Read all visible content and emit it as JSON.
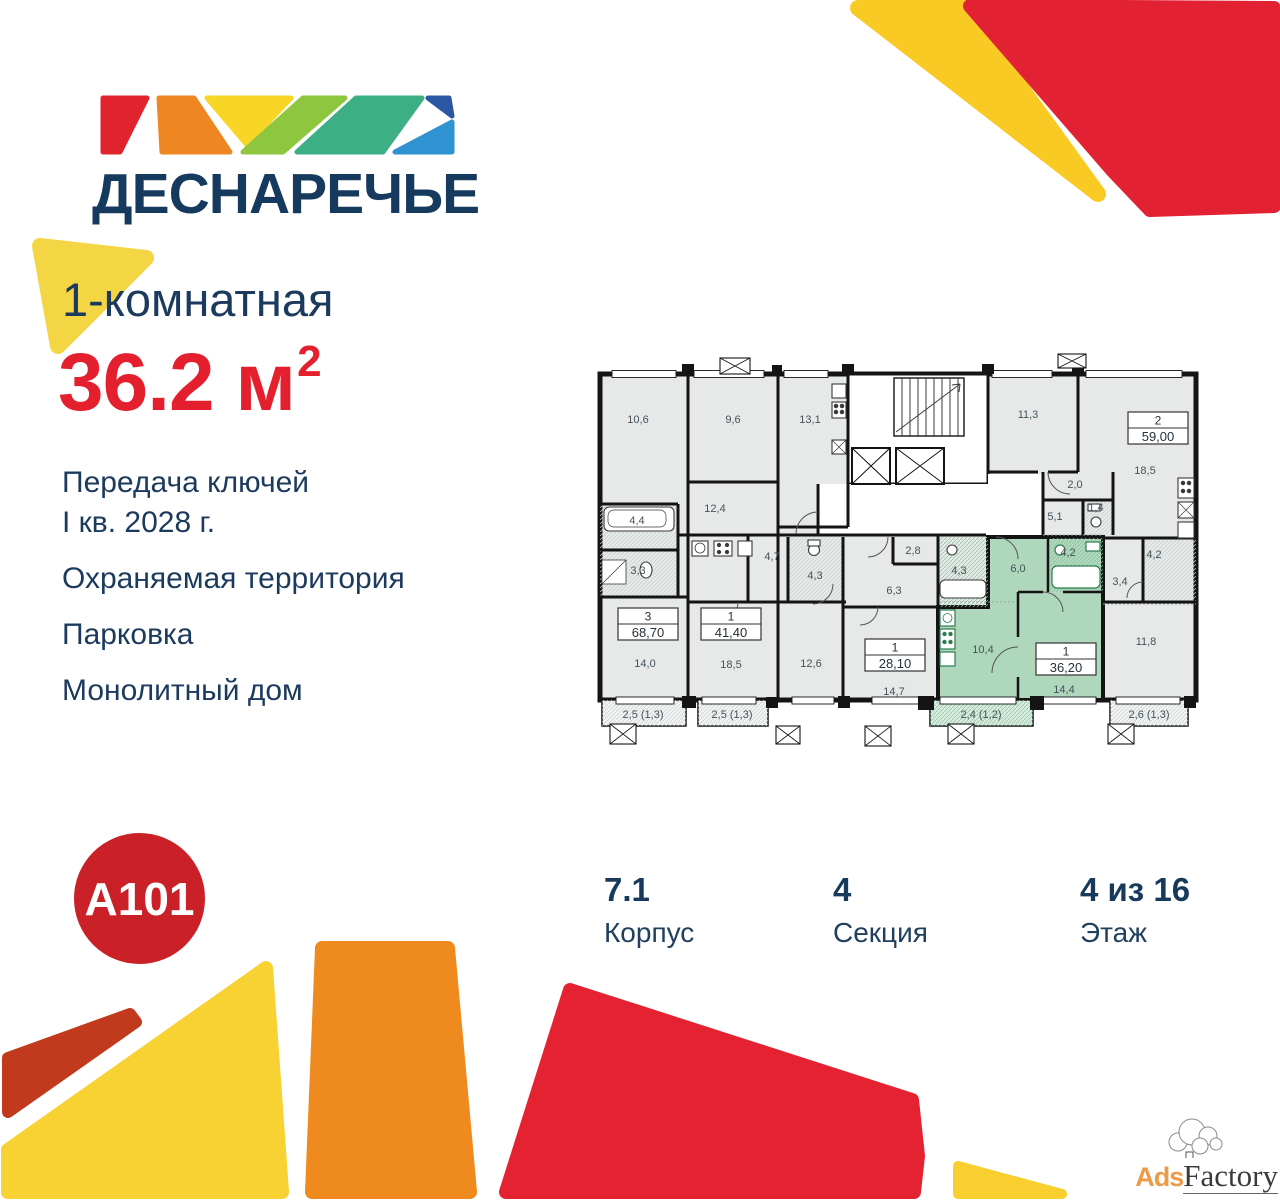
{
  "brand": {
    "name": "ДЕСНАРЕЧЬЕ",
    "developer": "А101"
  },
  "listing": {
    "rooms_label": "1-комнатная",
    "area": "36.2",
    "area_unit": "м",
    "area_sup": "2"
  },
  "features": [
    {
      "lines": [
        "Передача ключей",
        "I кв. 2028 г."
      ]
    },
    {
      "lines": [
        "Охраняемая территория"
      ]
    },
    {
      "lines": [
        "Парковка"
      ]
    },
    {
      "lines": [
        "Монолитный дом"
      ]
    }
  ],
  "stats": [
    {
      "value": "7.1",
      "label": "Корпус"
    },
    {
      "value": "4",
      "label": "Секция"
    },
    {
      "value": "4 из 16",
      "label": "Этаж"
    }
  ],
  "colors": {
    "navy": "#1b3a5d",
    "red": "#e4202e",
    "a101_red": "#c92127",
    "plan_gray": "#e6e9e8",
    "plan_green": "#aed7bb",
    "wall": "#141414",
    "deco_yellow": "#f6d73e",
    "deco_gold": "#f9ca24",
    "deco_orange": "#ee8a1e",
    "deco_red": "#e52231",
    "deco_brick": "#c13a1e"
  },
  "floorplan": {
    "highlighted_apartment": {
      "num": "1",
      "area": "36,20"
    },
    "room_labels": [
      {
        "t": "10,6",
        "x": 50,
        "y": 71
      },
      {
        "t": "9,6",
        "x": 145,
        "y": 71
      },
      {
        "t": "13,1",
        "x": 222,
        "y": 71
      },
      {
        "t": "11,3",
        "x": 440,
        "y": 66
      },
      {
        "t": "12,4",
        "x": 127,
        "y": 160
      },
      {
        "t": "4,4",
        "x": 49,
        "y": 172
      },
      {
        "t": "3,3",
        "x": 50,
        "y": 222
      },
      {
        "t": "4,7",
        "x": 184,
        "y": 208
      },
      {
        "t": "4,3",
        "x": 227,
        "y": 227
      },
      {
        "t": "2,8",
        "x": 325,
        "y": 202
      },
      {
        "t": "4,3",
        "x": 371,
        "y": 222
      },
      {
        "t": "6,3",
        "x": 306,
        "y": 242
      },
      {
        "t": "2,0",
        "x": 487,
        "y": 136
      },
      {
        "t": "5,1",
        "x": 467,
        "y": 168
      },
      {
        "t": "1,4",
        "x": 508,
        "y": 159
      },
      {
        "t": "6,0",
        "x": 430,
        "y": 220
      },
      {
        "t": "4,2",
        "x": 480,
        "y": 204
      },
      {
        "t": "3,4",
        "x": 532,
        "y": 233
      },
      {
        "t": "4,2",
        "x": 566,
        "y": 206
      },
      {
        "t": "18,5",
        "x": 557,
        "y": 122
      },
      {
        "t": "14,0",
        "x": 57,
        "y": 315
      },
      {
        "t": "18,5",
        "x": 143,
        "y": 316
      },
      {
        "t": "12,6",
        "x": 223,
        "y": 315
      },
      {
        "t": "14,7",
        "x": 306,
        "y": 343
      },
      {
        "t": "10,4",
        "x": 395,
        "y": 301
      },
      {
        "t": "14,4",
        "x": 476,
        "y": 341
      },
      {
        "t": "11,8",
        "x": 558,
        "y": 293
      },
      {
        "t": "2,5 (1,3)",
        "x": 55,
        "y": 366
      },
      {
        "t": "2,5 (1,3)",
        "x": 144,
        "y": 366
      },
      {
        "t": "2,4 (1,2)",
        "x": 393,
        "y": 366
      },
      {
        "t": "2,6 (1,3)",
        "x": 561,
        "y": 366
      }
    ],
    "apartment_boxes": [
      {
        "num": "3",
        "area": "68,70",
        "x": 30,
        "y": 256
      },
      {
        "num": "1",
        "area": "41,40",
        "x": 113,
        "y": 256
      },
      {
        "num": "1",
        "area": "28,10",
        "x": 277,
        "y": 287
      },
      {
        "num": "1",
        "area": "36,20",
        "x": 448,
        "y": 291
      },
      {
        "num": "2",
        "area": "59,00",
        "x": 540,
        "y": 60
      }
    ]
  },
  "watermark": {
    "ads": "Ads",
    "factory": "Factory"
  }
}
